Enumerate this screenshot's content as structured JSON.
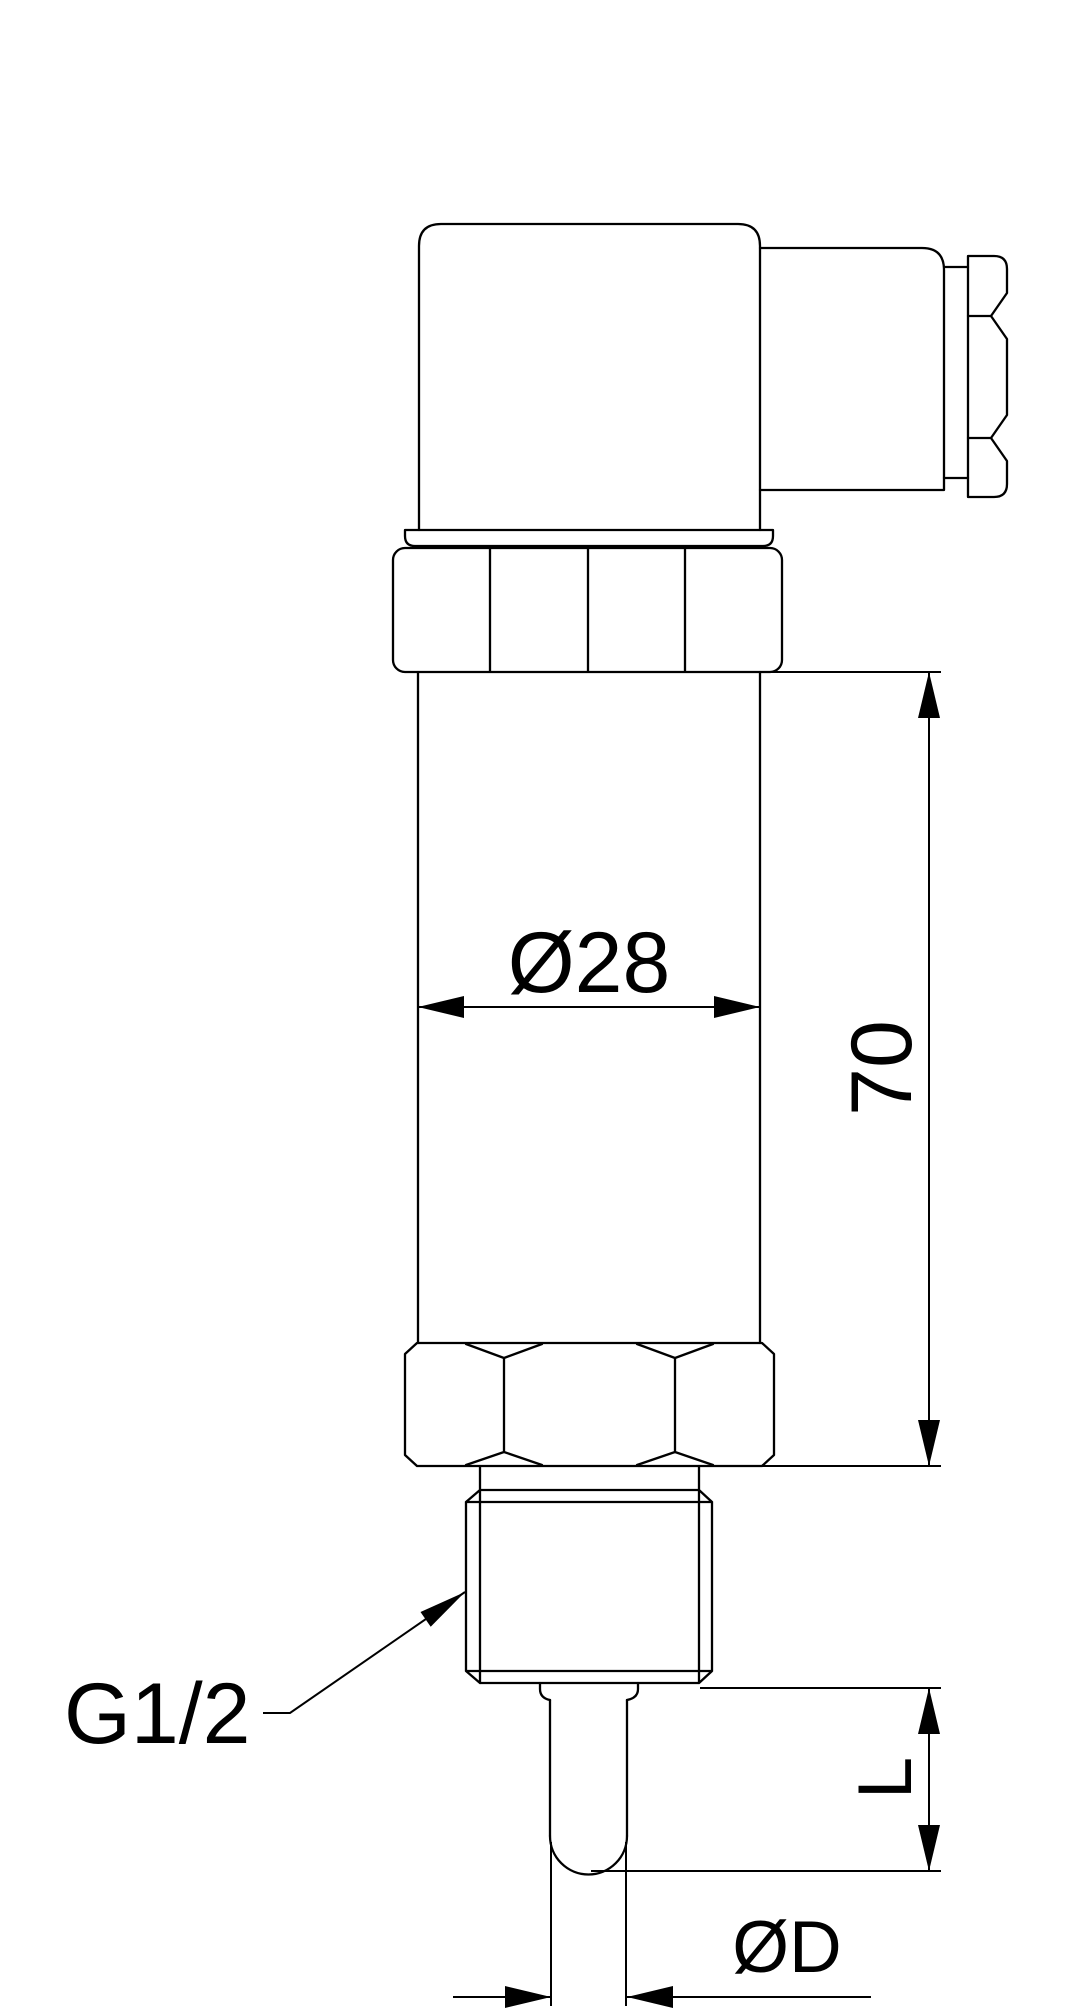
{
  "drawing": {
    "type": "technical-dimension-drawing",
    "subject": "screw-in temperature sensor / transmitter with DIN plug connector, side view",
    "colors": {
      "line": "#000000",
      "background": "#ffffff"
    },
    "labels": {
      "body_diameter": "Ø28",
      "body_length": "70",
      "thread_size": "G1/2",
      "insertion_length": "L",
      "probe_diameter": "ØD"
    }
  }
}
